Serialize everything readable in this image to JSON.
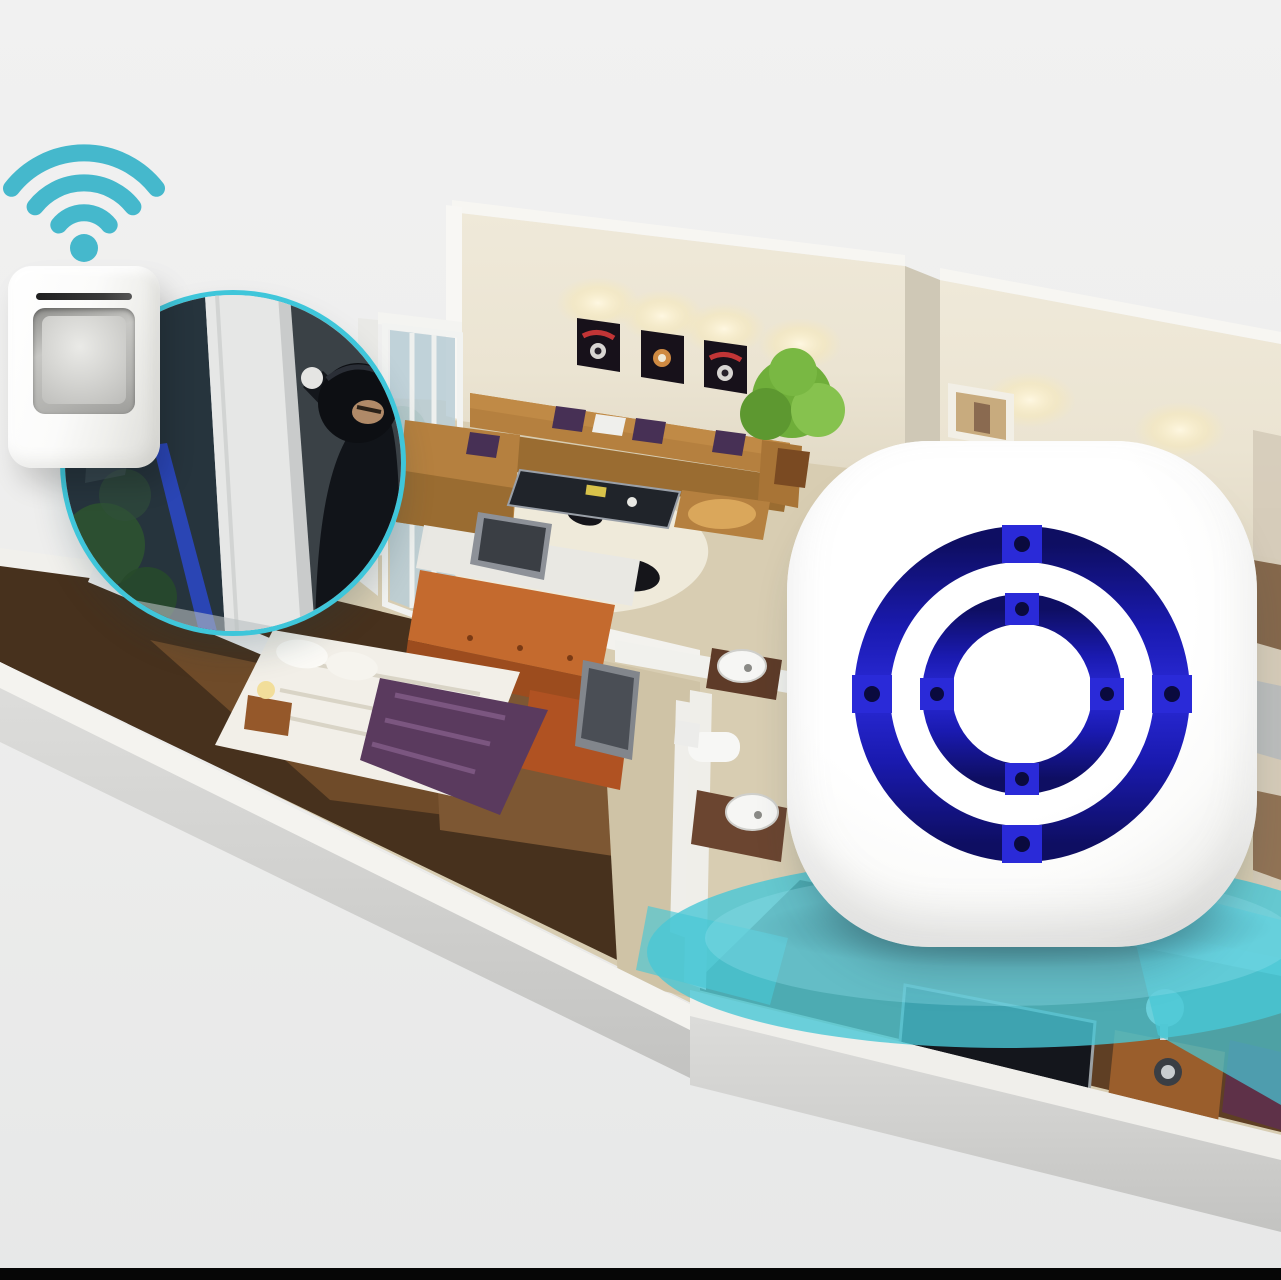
{
  "scene": {
    "description": "Product illustration of a wireless home security alarm: a PIR motion sensor detects a burglar entering a window and wirelessly triggers a plug-in chime receiver inside an isometric 3D apartment floor plan.",
    "background_top": "#f1f1f1",
    "background_bottom": "#e7e8e8",
    "bottom_bar": "#060606"
  },
  "palette": {
    "teal": "#45b8cc",
    "teal_bright": "#3fc6da",
    "teal_wave": "#48c7d6",
    "ring_blue_dark": "#0e0e62",
    "ring_blue": "#1a1ab0",
    "ring_blue_bright": "#2a2ad8",
    "dot_navy": "#0a0a3e",
    "wall_cream": "#ece5d4",
    "wall_top": "#f7f6f2",
    "floor_beige": "#d8cdb2",
    "floor_brown": "#47311d",
    "sofa_tan": "#b5803f",
    "sofa_seat": "#9a6c31",
    "pillow_purple": "#473055",
    "blanket_purple": "#5a3a5e",
    "dresser_orange": "#b45524",
    "plant_green": "#6fae3a",
    "glass_blue": "#b9ced6",
    "device_white": "#ffffff",
    "burglar_dark": "#111419"
  },
  "elements": {
    "wifi_icon": {
      "label": "wifi wireless signal icon"
    },
    "motion_sensor": {
      "label": "wireless PIR motion sensor unit"
    },
    "intruder_inset": {
      "label": "circular inset photo of burglar entering through window"
    },
    "floor_plan": {
      "label": "isometric 3D apartment floor plan with living room, bedrooms and bathroom"
    },
    "receiver": {
      "label": "white plug-in alarm receiver with two blue speaker rings"
    },
    "alert_waves": {
      "label": "teal alarm sound waves radiating on floor"
    },
    "bottom_bar": {
      "label": "black letterbox bar at bottom of image"
    }
  }
}
